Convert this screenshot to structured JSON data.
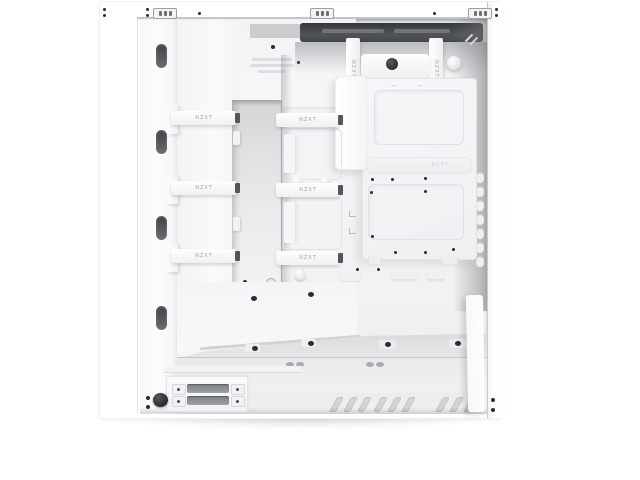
{
  "product": {
    "name": "white-mid-tower-pc-case",
    "description": "Interior cable-management side view of a white mid-tower PC case with side panel removed",
    "brand_label": "NZXT"
  },
  "straps": {
    "label": "NZXT",
    "horizontal_count": 6,
    "vertical_count": 2
  },
  "embossing": {
    "panel_label": "NZXT"
  },
  "colors": {
    "background": "#ffffff",
    "case_white": "#ffffff",
    "interior_light": "#f2f3f5",
    "recess_dark": "#3f4245",
    "grommet_dark": "#54575a",
    "drive_slot_grey": "#8f9295",
    "screw_dark": "#2a2d2f",
    "strap_text_grey": "#9fa2a5"
  }
}
